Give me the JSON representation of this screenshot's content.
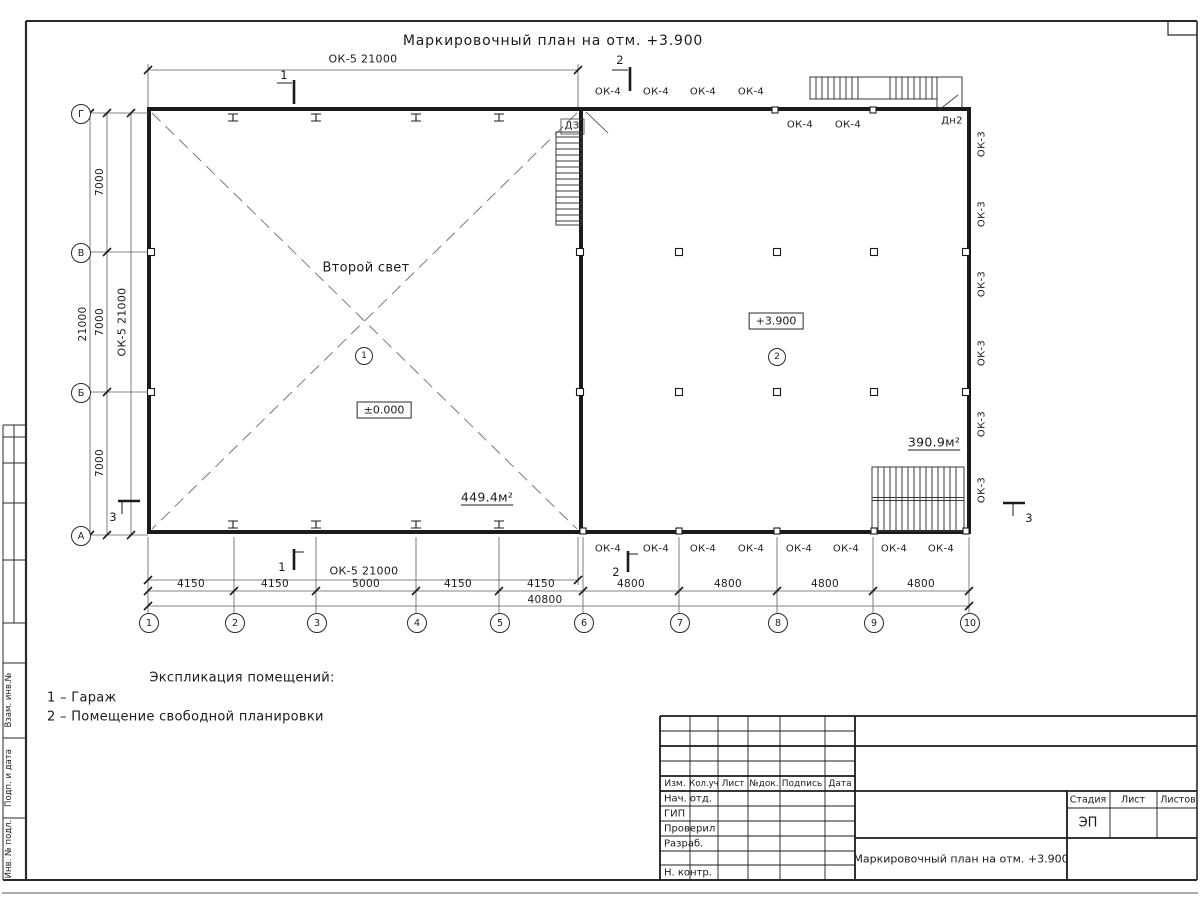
{
  "title": "Маркировочный план на отм. +3.900",
  "plan": {
    "dim_top": "ОК-5 21000",
    "dim_bottom_ok5": "ОК-5 21000",
    "dim_left_wall": "ОК-5 21000",
    "sec1": "1",
    "sec2": "2",
    "sec3": "3",
    "win_top_out": [
      "ОК-4",
      "ОК-4",
      "ОК-4",
      "ОК-4"
    ],
    "win_top_in": [
      "ОК-4",
      "ОК-4"
    ],
    "win_bottom": [
      "ОК-4",
      "ОК-4",
      "ОК-4",
      "ОК-4",
      "ОК-4",
      "ОК-4",
      "ОК-4",
      "ОК-4"
    ],
    "win_right": [
      "ОК-3",
      "ОК-3",
      "ОК-3",
      "ОК-3",
      "ОК-3",
      "ОК-3"
    ],
    "door_dn2": "Дн2",
    "door_dz": "ДЗ",
    "room1": {
      "label": "Второй свет",
      "num": "1",
      "level": "±0.000",
      "area": "449.4м²"
    },
    "room2": {
      "num": "2",
      "level": "+3.900",
      "area": "390.9м²"
    },
    "axes_x": [
      "1",
      "2",
      "3",
      "4",
      "5",
      "6",
      "7",
      "8",
      "9",
      "10"
    ],
    "axes_y": [
      "Г",
      "В",
      "Б",
      "А"
    ],
    "dims_x": [
      "4150",
      "4150",
      "5000",
      "4150",
      "4150",
      "4800",
      "4800",
      "4800",
      "4800"
    ],
    "dims_x_total": "40800",
    "dims_y": [
      "7000",
      "7000",
      "7000"
    ],
    "dims_y_total": "21000"
  },
  "legend": {
    "heading": "Экспликация помещений:",
    "item1": "1 – Гараж",
    "item2": "2 – Помещение свободной планировки"
  },
  "titleblock": {
    "cols": [
      "Изм.",
      "Кол.уч",
      "Лист",
      "№док.",
      "Подпись",
      "Дата"
    ],
    "rows": [
      "Нач. отд.",
      "ГИП",
      "Проверил",
      "Разраб.",
      "Н. контр."
    ],
    "doc_title": "Маркировочный план на отм. +3.900",
    "stage_cols": [
      "Стадия",
      "Лист",
      "Листов"
    ],
    "stage": "ЭП"
  },
  "side_stamp": [
    "Взам. инв.№",
    "Подп. и дата",
    "Инв. № подл."
  ]
}
